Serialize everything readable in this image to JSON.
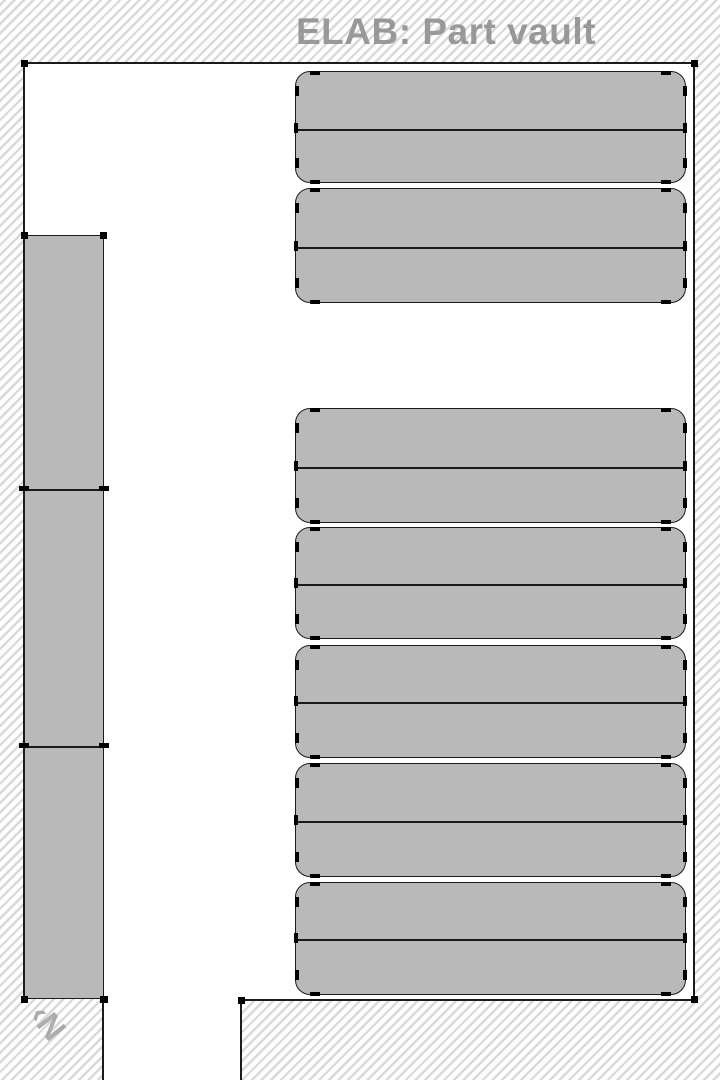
{
  "title": "ELAB: Part vault",
  "compass": {
    "text": "‹N"
  },
  "colors": {
    "background": "#ffffff",
    "hatch_stripe": "#d9d9d9",
    "outline": "#1b1b1b",
    "rack_fill": "#b9b9b9",
    "marker": "#000000",
    "title_text": "#8d8d8d",
    "compass_text": "#9c9c9c"
  },
  "plan": {
    "canvas": {
      "w": 720,
      "h": 1080
    },
    "room_areas": [
      {
        "name": "main-room",
        "x": 24,
        "y": 63,
        "w": 670,
        "h": 936
      },
      {
        "name": "doorway-corridor",
        "x": 104,
        "y": 999,
        "w": 136,
        "h": 81
      }
    ],
    "walls": [
      {
        "name": "wall-top",
        "x": 23,
        "y": 62,
        "w": 673,
        "h": 2
      },
      {
        "name": "wall-left",
        "x": 23,
        "y": 62,
        "w": 2,
        "h": 938
      },
      {
        "name": "wall-right",
        "x": 693,
        "y": 62,
        "w": 2,
        "h": 938
      },
      {
        "name": "wall-bottom-under-rack",
        "x": 23,
        "y": 997,
        "w": 82,
        "h": 2
      },
      {
        "name": "wall-notch-vertical",
        "x": 102,
        "y": 998,
        "w": 2,
        "h": 82
      },
      {
        "name": "wall-bottom-right",
        "x": 240,
        "y": 999,
        "w": 455,
        "h": 2
      },
      {
        "name": "wall-corridor-right",
        "x": 240,
        "y": 999,
        "w": 2,
        "h": 81
      }
    ],
    "corner_markers": [
      {
        "x": 24,
        "y": 63
      },
      {
        "x": 694,
        "y": 63
      },
      {
        "x": 694,
        "y": 999
      },
      {
        "x": 24,
        "y": 999
      },
      {
        "x": 103,
        "y": 999
      },
      {
        "x": 241,
        "y": 1000
      },
      {
        "x": 24,
        "y": 235
      },
      {
        "x": 103,
        "y": 235
      }
    ],
    "left_rack": {
      "x": 24,
      "y": 235,
      "w": 80,
      "h": 764,
      "dividers_y": [
        488,
        745
      ]
    },
    "shelf_groups": [
      {
        "x": 295,
        "y": 71,
        "w": 391,
        "h": 112,
        "divider_y": 128
      },
      {
        "x": 295,
        "y": 188,
        "w": 391,
        "h": 115,
        "divider_y": 246
      },
      {
        "x": 295,
        "y": 408,
        "w": 391,
        "h": 115,
        "divider_y": 466
      },
      {
        "x": 295,
        "y": 527,
        "w": 391,
        "h": 112,
        "divider_y": 583
      },
      {
        "x": 295,
        "y": 645,
        "w": 391,
        "h": 113,
        "divider_y": 701
      },
      {
        "x": 295,
        "y": 763,
        "w": 391,
        "h": 114,
        "divider_y": 820
      },
      {
        "x": 295,
        "y": 882,
        "w": 391,
        "h": 113,
        "divider_y": 938
      }
    ]
  }
}
